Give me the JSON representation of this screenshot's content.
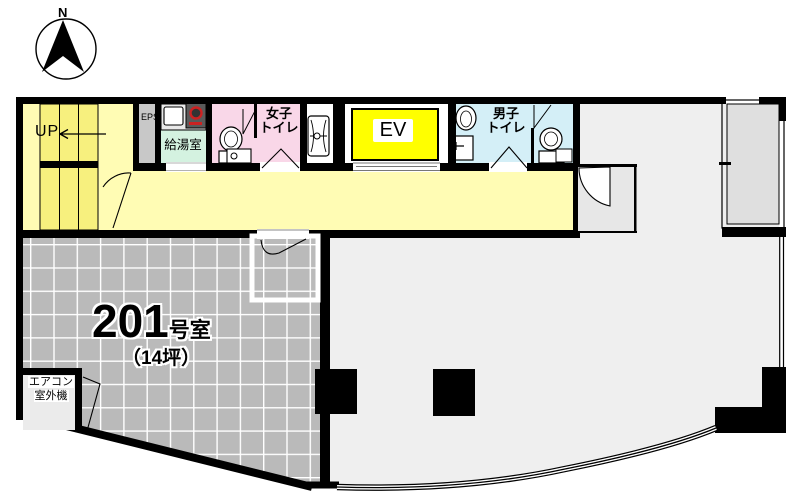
{
  "plan": {
    "title": "Floor plan of room 201",
    "compass": {
      "north_label": "N"
    },
    "rooms": {
      "stairs": {
        "label": "UP"
      },
      "eps_shaft": {
        "label": "EPS"
      },
      "kitchenette": {
        "label": "給湯室"
      },
      "womens_toilet": {
        "line1": "女子",
        "line2": "トイレ"
      },
      "elevator": {
        "label": "EV"
      },
      "mens_toilet": {
        "line1": "男子",
        "line2": "トイレ"
      },
      "main_room": {
        "number": "201",
        "suffix": "号室",
        "area": "（14坪）"
      },
      "aircon_unit": {
        "line1": "エアコン",
        "line2": "室外機"
      }
    },
    "colors": {
      "wall": "#000000",
      "corridor_yellow": "#FFFCB4",
      "stair_tread_yellow": "#F7F07E",
      "elevator_yellow": "#FFFF00",
      "womens_pink": "#F9D7E8",
      "mens_cyan": "#D4EFF7",
      "kitchen_mint": "#D4F2E0",
      "eps_gray": "#C8C8C8",
      "terrace_gray": "#BABABA",
      "main_floor_gray": "#EFEFEF",
      "balcony_gray": "#DFDFDF",
      "burner_red": "#CC2222"
    }
  }
}
